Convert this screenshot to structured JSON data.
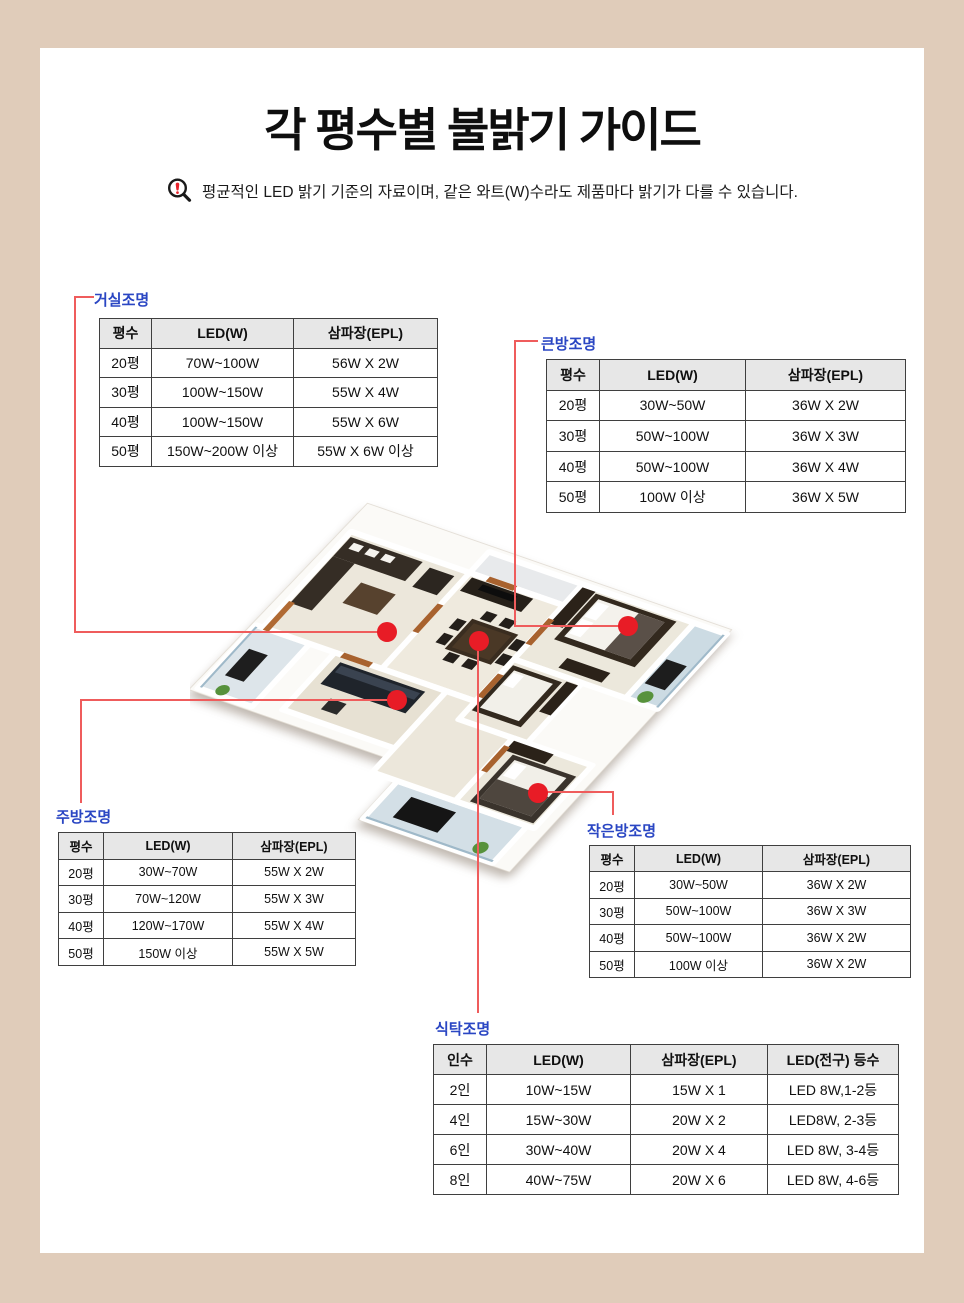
{
  "page": {
    "title": "각 평수별 불밝기 가이드",
    "disclaimer": "평균적인 LED 밝기 기준의 자료이며, 같은 와트(W)수라도 제품마다 밝기가 다를 수 있습니다."
  },
  "colors": {
    "frame_beige": "#e0ccba",
    "panel_white": "#ffffff",
    "label_blue": "#2a46c3",
    "connector_red": "#ef5c5c",
    "marker_dot_red": "#e81c26",
    "table_header_bg": "#e7e7e7",
    "table_border": "#3f3f3f",
    "notice_exclamation_red": "#e8232b"
  },
  "icons": {
    "notice": "magnifier-with-exclamation-icon"
  },
  "tables": {
    "living": {
      "label": "거실조명",
      "headers": [
        "평수",
        "LED(W)",
        "삼파장(EPL)"
      ],
      "rows": [
        [
          "20평",
          "70W~100W",
          "56W X 2W"
        ],
        [
          "30평",
          "100W~150W",
          "55W X 4W"
        ],
        [
          "40평",
          "100W~150W",
          "55W X 6W"
        ],
        [
          "50평",
          "150W~200W 이상",
          "55W X 6W 이상"
        ]
      ]
    },
    "bigroom": {
      "label": "큰방조명",
      "headers": [
        "평수",
        "LED(W)",
        "삼파장(EPL)"
      ],
      "rows": [
        [
          "20평",
          "30W~50W",
          "36W X 2W"
        ],
        [
          "30평",
          "50W~100W",
          "36W X 3W"
        ],
        [
          "40평",
          "50W~100W",
          "36W X 4W"
        ],
        [
          "50평",
          "100W 이상",
          "36W X 5W"
        ]
      ]
    },
    "kitchen": {
      "label": "주방조명",
      "headers": [
        "평수",
        "LED(W)",
        "삼파장(EPL)"
      ],
      "rows": [
        [
          "20평",
          "30W~70W",
          "55W X 2W"
        ],
        [
          "30평",
          "70W~120W",
          "55W X 3W"
        ],
        [
          "40평",
          "120W~170W",
          "55W X 4W"
        ],
        [
          "50평",
          "150W 이상",
          "55W X 5W"
        ]
      ]
    },
    "smallroom": {
      "label": "작은방조명",
      "headers": [
        "평수",
        "LED(W)",
        "삼파장(EPL)"
      ],
      "rows": [
        [
          "20평",
          "30W~50W",
          "36W X 2W"
        ],
        [
          "30평",
          "50W~100W",
          "36W X 3W"
        ],
        [
          "40평",
          "50W~100W",
          "36W X 2W"
        ],
        [
          "50평",
          "100W 이상",
          "36W X 2W"
        ]
      ]
    },
    "dining": {
      "label": "식탁조명",
      "headers": [
        "인수",
        "LED(W)",
        "삼파장(EPL)",
        "LED(전구) 등수"
      ],
      "rows": [
        [
          "2인",
          "10W~15W",
          "15W X 1",
          "LED 8W,1-2등"
        ],
        [
          "4인",
          "15W~30W",
          "20W X 2",
          "LED8W, 2-3등"
        ],
        [
          "6인",
          "30W~40W",
          "20W X 4",
          "LED 8W, 3-4등"
        ],
        [
          "8인",
          "40W~75W",
          "20W X 6",
          "LED 8W, 4-6등"
        ]
      ]
    }
  }
}
